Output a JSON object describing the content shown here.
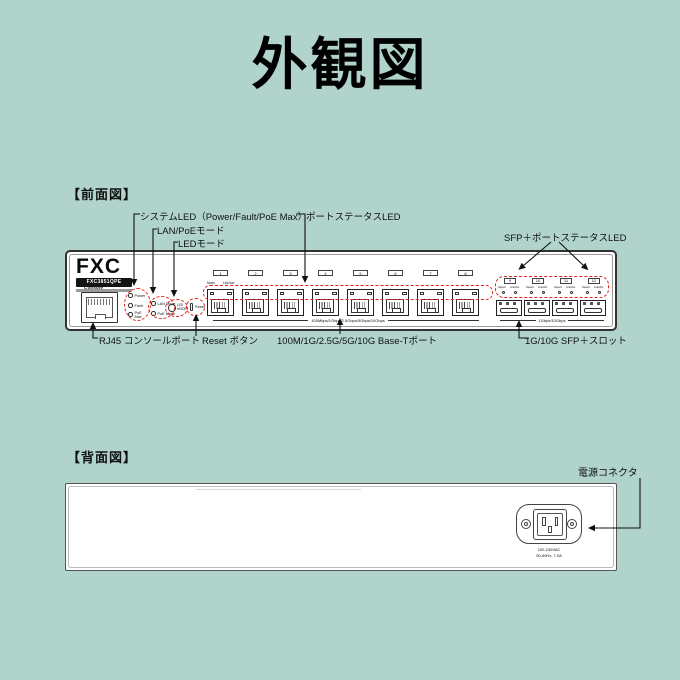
{
  "page": {
    "title": "外観図",
    "background": "#b0d3cc"
  },
  "colors": {
    "highlight_dashed": "#e2231a",
    "panel_line": "#333333"
  },
  "front": {
    "section_label": "【前面図】",
    "callouts": {
      "system_led": "システムLED（Power/Fault/PoE Max）",
      "port_status_led": "ポートステータスLED",
      "lan_poe_mode": "LAN/PoEモード",
      "led_mode": "LEDモード",
      "sfp_port_status_led": "SFP＋ポートステータスLED",
      "console": "RJ45 コンソールポート",
      "reset": "Reset ボタン",
      "base_t_ports": "100M/1G/2.5G/5G/10G Base-Tポート",
      "sfp_slots": "1G/10G SFP＋スロット"
    },
    "panel": {
      "brand": "FXC",
      "model": "FXC3851QPE",
      "console_label": "Console",
      "system_leds": [
        "Power",
        "Fault",
        "PoE Max"
      ],
      "mode_leds": [
        "LAN Mode",
        "PoE Mode"
      ],
      "led_mode_button": "LED MODE",
      "reset_label": "Reset",
      "port_header_labels": [
        "Mode",
        "Link/Act"
      ],
      "rj45_ports": [
        "1",
        "2",
        "3",
        "4",
        "5",
        "6",
        "7",
        "8"
      ],
      "rj45_speed_note": "100Mbps/1Gbps/2.5Gbps/5Gbps/10Gbps",
      "sfp_ports": [
        "9",
        "10",
        "11",
        "12"
      ],
      "sfp_led_labels": [
        "Speed",
        "Link/Act"
      ],
      "sfp_speed_note": "1Gbps/10Gbps"
    }
  },
  "rear": {
    "section_label": "【背面図】",
    "power_connector_label": "電源コネクタ",
    "power_rating_line1": "100-240VAC",
    "power_rating_line2": "50-60Hz, 7.0A"
  }
}
